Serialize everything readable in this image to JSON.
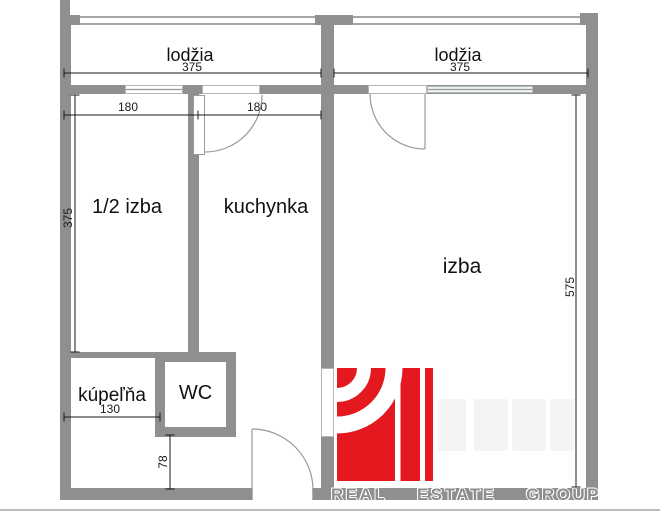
{
  "floorplan": {
    "loggia_left_label": "lodžia",
    "loggia_right_label": "lodžia",
    "half_room_label": "1/2 izba",
    "kitchen_label": "kuchynka",
    "room_label": "izba",
    "bathroom_label": "kúpeľňa",
    "wc_label": "WC",
    "dim_loggia_left": "375",
    "dim_loggia_right": "375",
    "dim_half_room_w": "180",
    "dim_kitchen_w": "180",
    "dim_half_room_h": "375",
    "dim_room_h": "575",
    "dim_bathroom_w": "130",
    "dim_hall_h": "78"
  },
  "watermark": {
    "word_real": "REAL",
    "word_estate": "ESTATE",
    "word_group": "GROUP"
  },
  "colors": {
    "wall": "#8f8f8f",
    "wall_light": "#a6a6a6",
    "logo_red": "#e3191f",
    "dim_line": "#1a1a1a",
    "watermark_gray": "#8d8d8d",
    "window_glass": "#eef3f3"
  }
}
